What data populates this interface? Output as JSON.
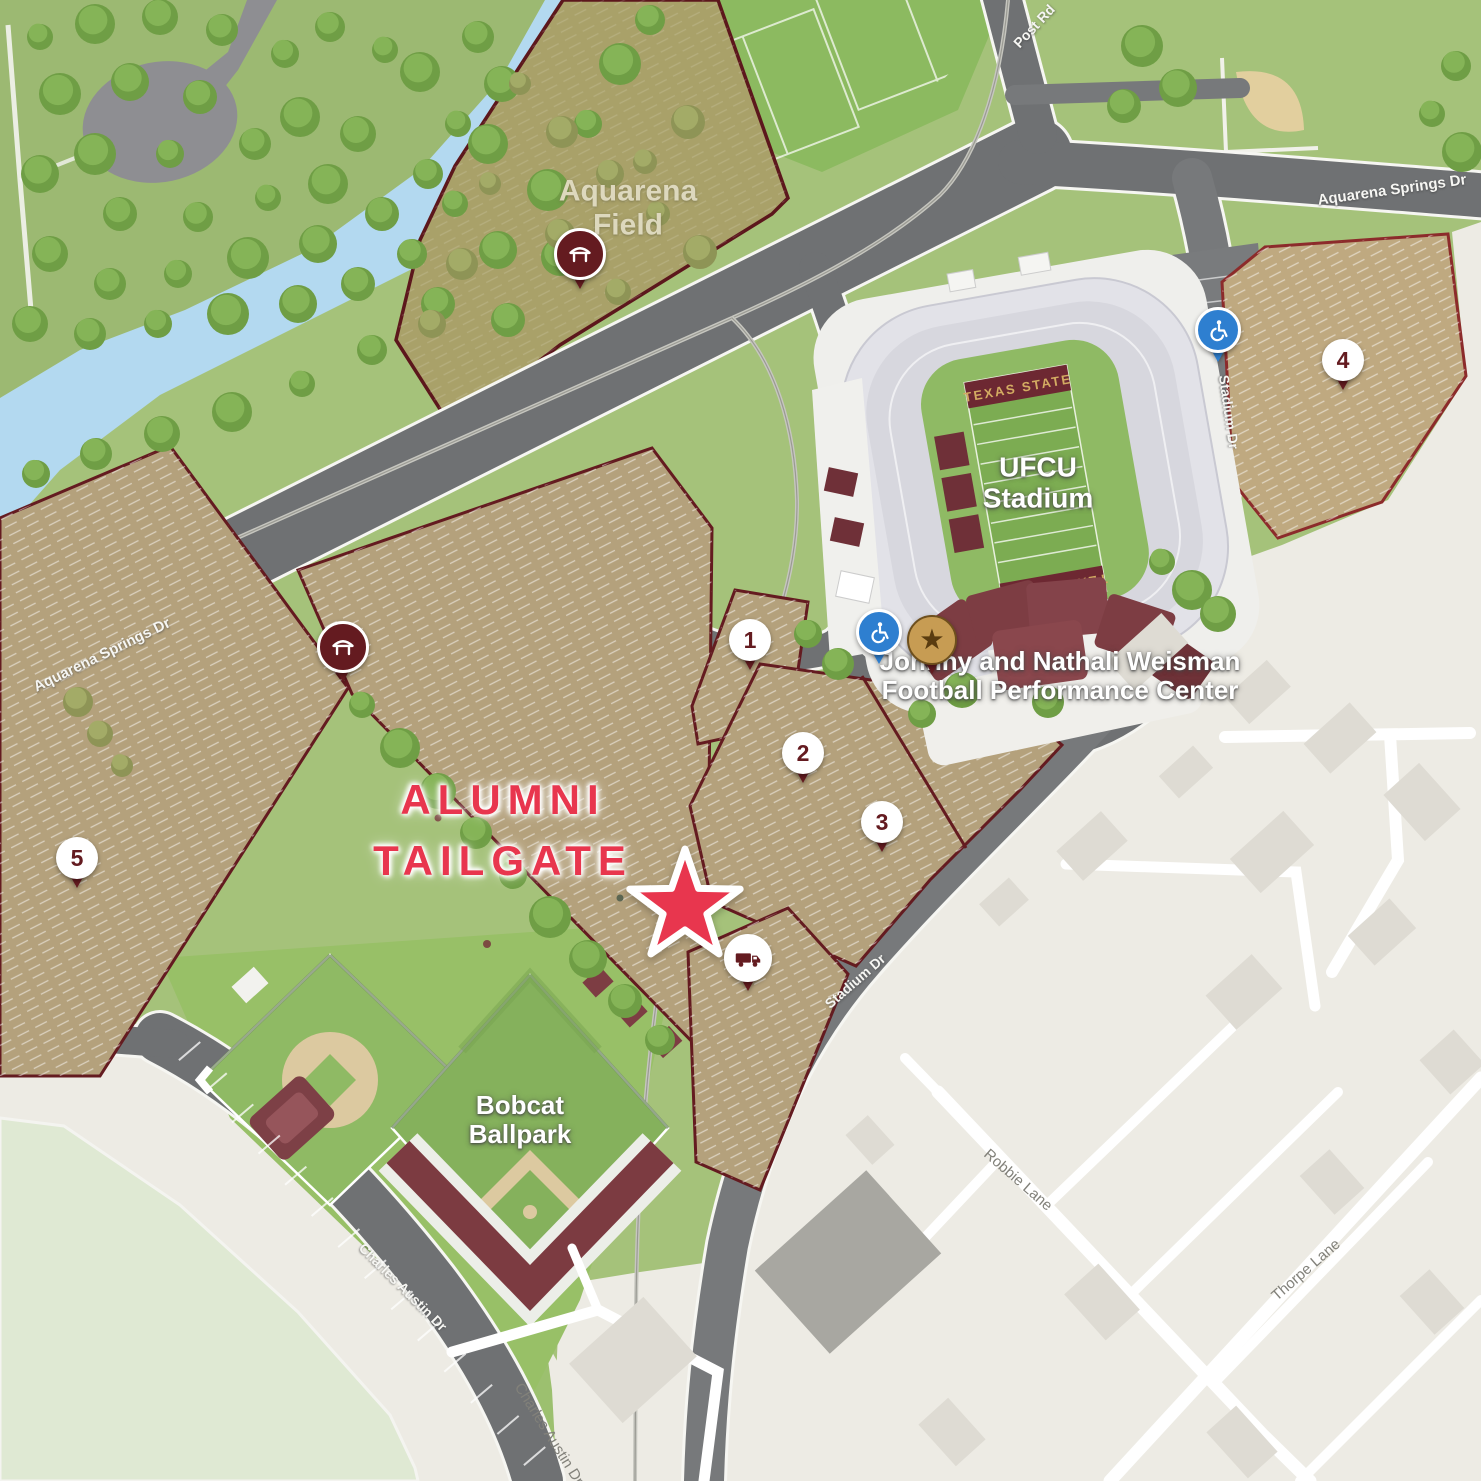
{
  "map": {
    "type": "campus-tailgate-map",
    "labels": {
      "aquarena_field_line1": "Aquarena",
      "aquarena_field_line2": "Field",
      "ufcu_stadium_line1": "UFCU",
      "ufcu_stadium_line2": "Stadium",
      "performance_center_line1": "Johnny and Nathali Weisman",
      "performance_center_line2": "Football Performance Center",
      "bobcat_ballpark_line1": "Bobcat",
      "bobcat_ballpark_line2": "Ballpark"
    },
    "annotation": {
      "line1": "ALUMNI",
      "line2": "TAILGATE"
    },
    "roads": {
      "post_rd": "Post Rd",
      "aquarena_springs_dr_east": "Aquarena Springs Dr",
      "aquarena_springs_dr_west": "Aquarena Springs Dr",
      "stadium_dr_north": "Stadium Dr",
      "stadium_dr_south": "Stadium Dr",
      "charles_austin_dr_campus": "Charles Austin Dr",
      "charles_austin_dr_city": "Charles Austin Dr",
      "robbie_lane": "Robbie Lane",
      "thorpe_lane": "Thorpe Lane"
    },
    "stadium_field": {
      "end_zone_top": "TEXAS STATE",
      "end_zone_bottom": "TEXAS STATE"
    },
    "parking_pins": {
      "lot1": "1",
      "lot2": "2",
      "lot3": "3",
      "lot4": "4",
      "lot5": "5"
    },
    "glyphs": {
      "star": "★"
    },
    "icons": {
      "tent_pin": "tent-icon",
      "rv_pin": "rv-icon",
      "accessible_pin": "accessible-icon",
      "campus_star_pin": "star-icon",
      "tailgate_marker": "star-marker-icon"
    },
    "colors": {
      "accent_red": "#e8364e",
      "maroon": "#641b20",
      "lot_tan": "#b4a17c",
      "grass": "#a5c27a",
      "river_blue": "#b3d9f0",
      "city_beige": "#edebe4",
      "accessible_blue": "#2e7fd0",
      "star_gold": "#c79c53"
    }
  }
}
